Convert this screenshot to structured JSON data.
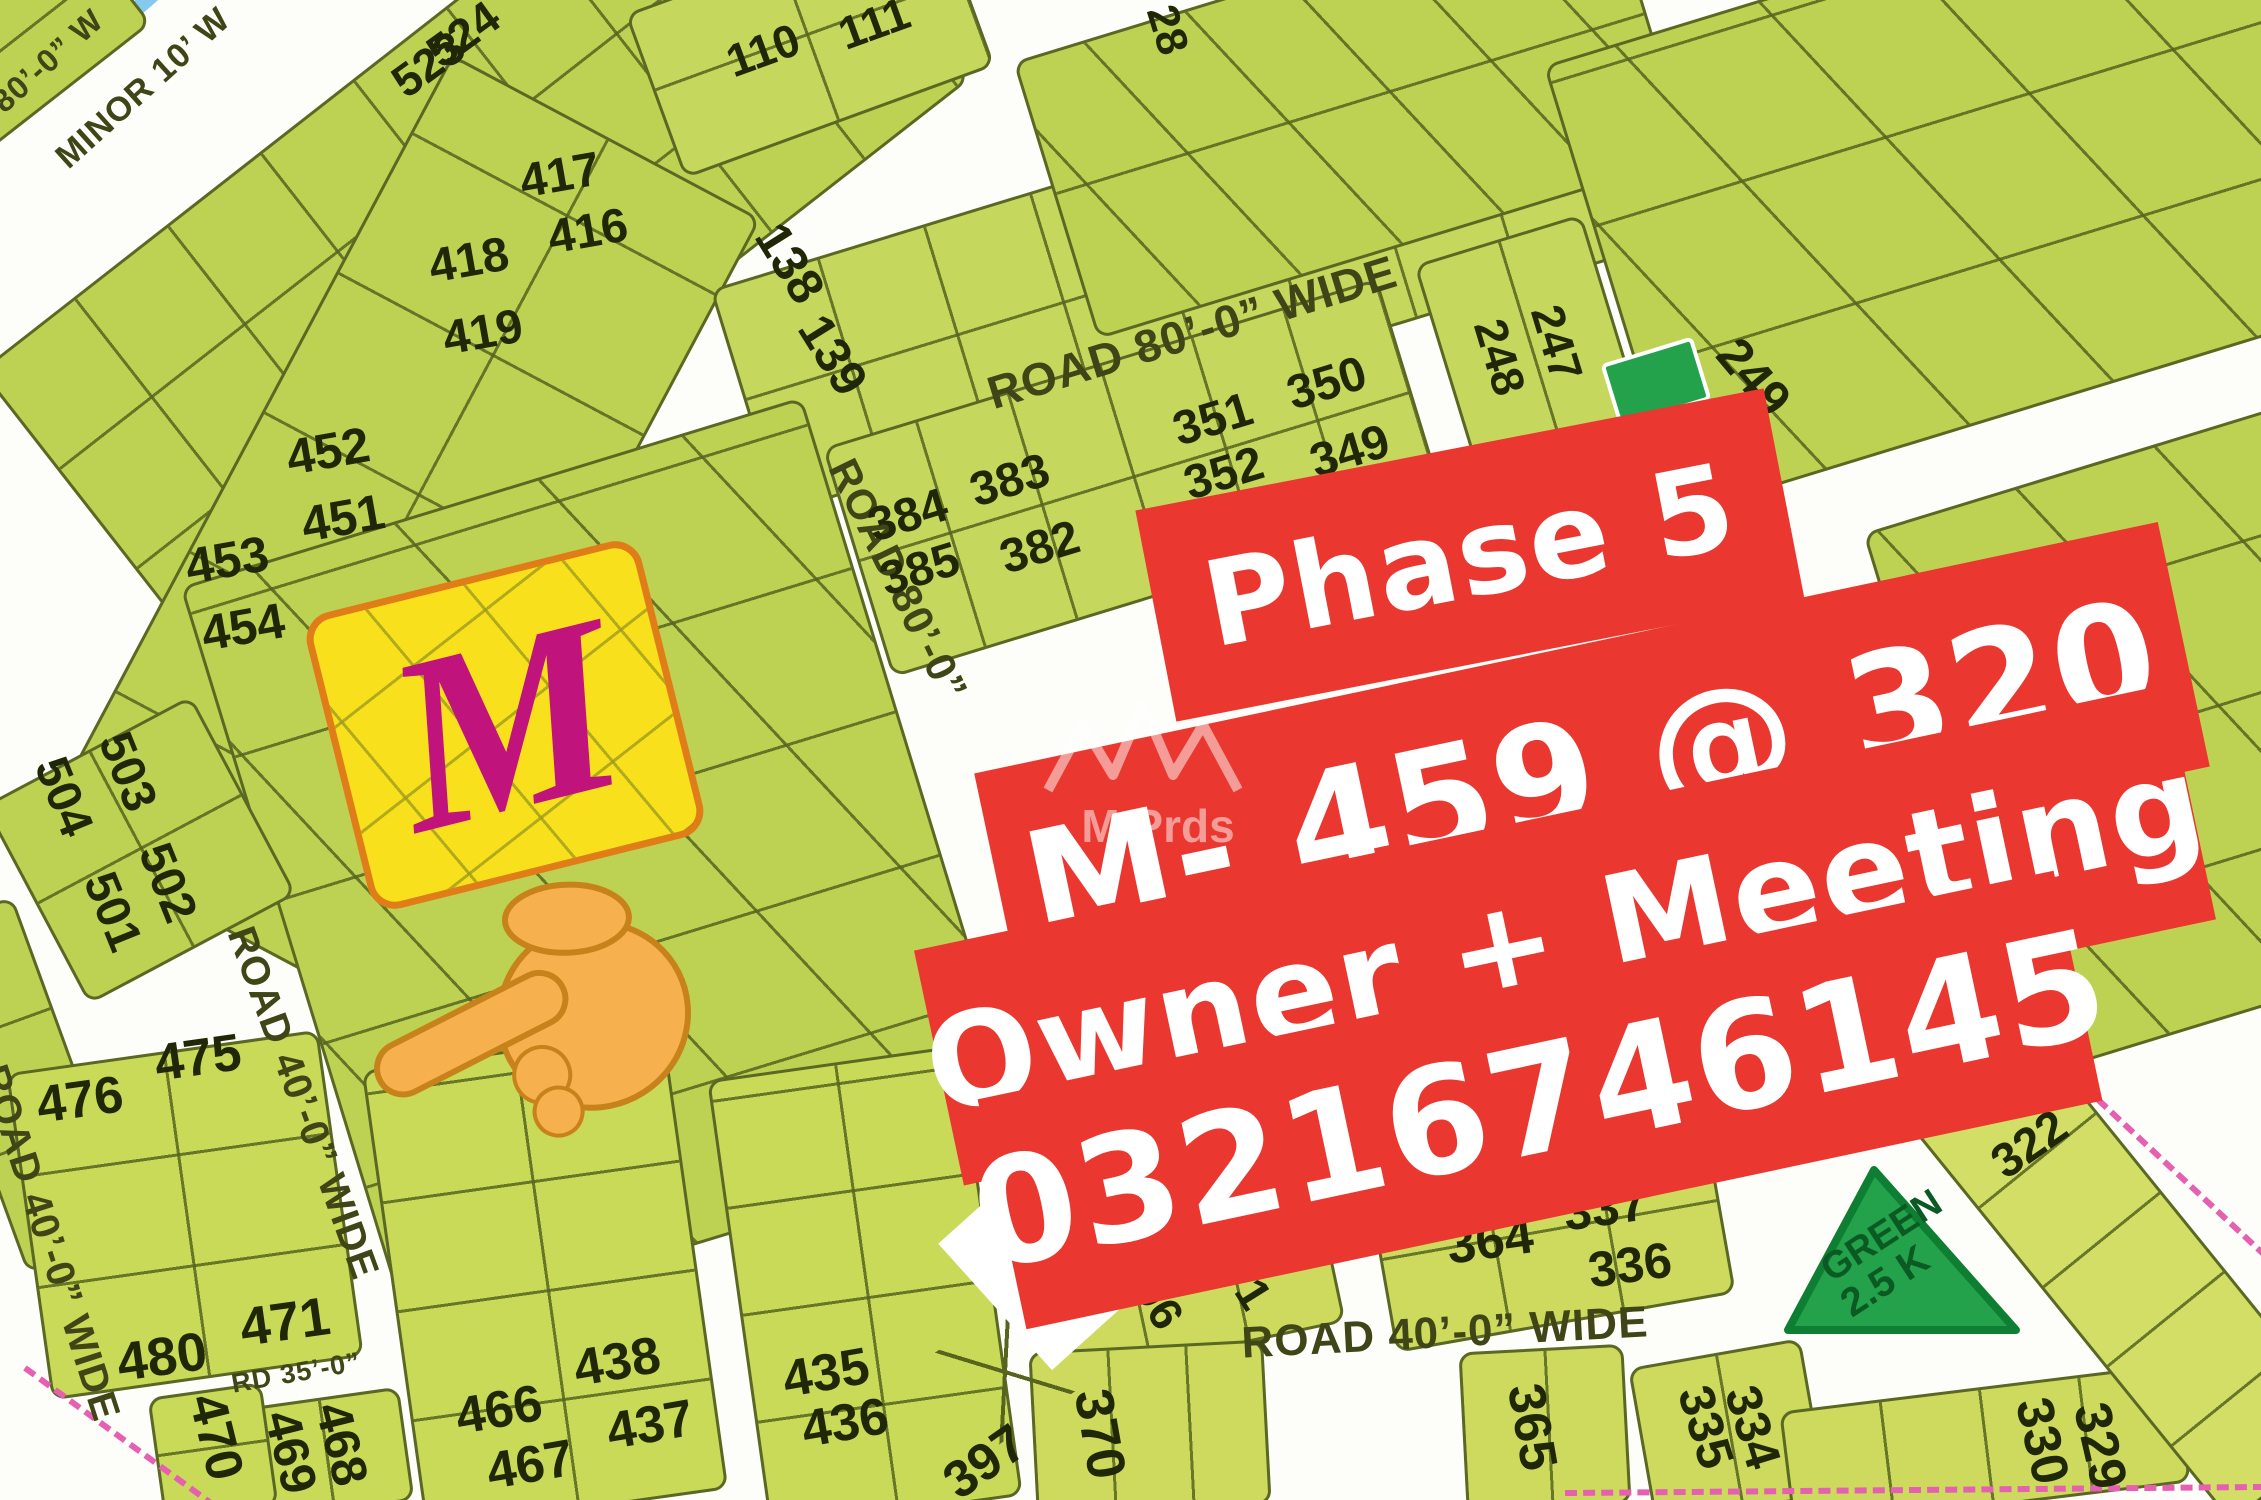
{
  "canvas": {
    "width": 2261,
    "height": 1500,
    "background": "#fdfdfa"
  },
  "colors": {
    "plot_green": "#bdd253",
    "plot_green_light": "#c6d75e",
    "plot_green_warm": "#cdda5e",
    "grid_line": "#56641e",
    "road_white": "#ffffff",
    "sticker_red": "#ea3830",
    "label_dark": "#1f2706",
    "park_green": "#23a14b",
    "canal_blue": "#85c9ec",
    "boundary_pink": "#e560b0",
    "logo_yellow": "#f8e01c",
    "logo_border_orange": "#e07d18",
    "logo_magenta": "#c0137c",
    "hand_skin": "#f6b04e"
  },
  "overlay": {
    "lines": [
      {
        "text": "Phase 5",
        "cx": 1470,
        "cy": 555,
        "w": 640,
        "h": 215,
        "rot": -11,
        "fs": 118
      },
      {
        "text": "M- 459 @ 320",
        "cx": 1592,
        "cy": 770,
        "w": 1210,
        "h": 250,
        "rot": -12,
        "fs": 148
      },
      {
        "text": "Owner + Meeting",
        "cx": 1565,
        "cy": 935,
        "w": 1280,
        "h": 240,
        "rot": -12,
        "fs": 130
      },
      {
        "text": "03216746145",
        "cx": 1540,
        "cy": 1100,
        "w": 1100,
        "h": 235,
        "rot": -12,
        "fs": 148
      }
    ],
    "fold_wedge": {
      "cx": 1075,
      "cy": 1235,
      "w": 215,
      "h": 170,
      "rot": -42
    }
  },
  "logo": {
    "letter": "M",
    "cx": 505,
    "cy": 725,
    "w": 345,
    "h": 305,
    "rot": -14,
    "font_size": 250
  },
  "hand": {
    "icon": "pointing-hand",
    "cx": 540,
    "cy": 1020,
    "w": 350,
    "h": 280,
    "rot": -27
  },
  "watermark": {
    "text": "M Prds",
    "cx": 1158,
    "cy": 775
  },
  "map": {
    "blocks": [
      {
        "id": "A",
        "cx": 475,
        "cy": 225,
        "w": 960,
        "h": 380,
        "rot": -38,
        "col": 118,
        "row": 126,
        "fill": "#bdd253"
      },
      {
        "id": "A2",
        "cx": 15,
        "cy": 35,
        "w": 230,
        "h": 150,
        "rot": -38,
        "col": 0,
        "row": 70,
        "fill": "#bdd253"
      },
      {
        "id": "B",
        "cx": 400,
        "cy": 525,
        "w": 350,
        "h": 880,
        "rot": 28,
        "col": 176,
        "row": 158,
        "fill": "#bdd253"
      },
      {
        "id": "C1",
        "cx": 810,
        "cy": 40,
        "w": 330,
        "h": 175,
        "rot": -20,
        "col": 163,
        "row": 92,
        "fill": "#c6d75e"
      },
      {
        "id": "C2",
        "cx": 1170,
        "cy": 272,
        "w": 890,
        "h": 235,
        "rot": -17,
        "col": 111,
        "row": 118,
        "fill": "#c6d75e"
      },
      {
        "id": "D1",
        "cx": 1135,
        "cy": 478,
        "w": 580,
        "h": 240,
        "rot": -17,
        "col": 96,
        "row": 120,
        "fill": "#c6d75e"
      },
      {
        "id": "D2",
        "cx": 1532,
        "cy": 352,
        "w": 175,
        "h": 235,
        "rot": -17,
        "col": 87,
        "row": 0,
        "fill": "#c6d75e"
      },
      {
        "id": "E1",
        "cx": 1352,
        "cy": 110,
        "w": 620,
        "h": 290,
        "rot": -17,
        "col": 95,
        "row": 150,
        "slant": true,
        "fill": "#bdd253"
      },
      {
        "id": "E2",
        "cx": 1990,
        "cy": 175,
        "w": 790,
        "h": 470,
        "rot": -17,
        "col": 135,
        "row": 150,
        "slant": true,
        "fill": "#bdd253"
      },
      {
        "id": "F",
        "cx": 2195,
        "cy": 730,
        "w": 520,
        "h": 570,
        "rot": -17,
        "col": 130,
        "row": 150,
        "slant": true,
        "fill": "#bdd253"
      },
      {
        "id": "L",
        "cx": 605,
        "cy": 865,
        "w": 650,
        "h": 780,
        "rot": -17,
        "col": 135,
        "row": 150,
        "slant": true,
        "fill": "#bdd253"
      },
      {
        "id": "J2",
        "cx": 140,
        "cy": 850,
        "w": 235,
        "h": 225,
        "rot": -28,
        "col": 118,
        "row": 112,
        "fill": "#bdd253"
      },
      {
        "id": "J1",
        "cx": 20,
        "cy": 1085,
        "w": 115,
        "h": 360,
        "rot": -20,
        "col": 0,
        "row": 120,
        "fill": "#bdd253"
      },
      {
        "id": "K",
        "cx": 185,
        "cy": 1215,
        "w": 315,
        "h": 330,
        "rot": -8,
        "col": 158,
        "row": 112,
        "fill": "#c9d958"
      },
      {
        "id": "K2",
        "cx": 325,
        "cy": 1455,
        "w": 165,
        "h": 115,
        "rot": -8,
        "col": 83,
        "row": 0,
        "fill": "#c9d958"
      },
      {
        "id": "K3",
        "cx": 213,
        "cy": 1452,
        "w": 115,
        "h": 125,
        "rot": -8,
        "col": 0,
        "row": 65,
        "fill": "#c9d958"
      },
      {
        "id": "H1",
        "cx": 545,
        "cy": 1280,
        "w": 305,
        "h": 465,
        "rot": -8,
        "col": 153,
        "row": 110,
        "fill": "#c9d958"
      },
      {
        "id": "H2",
        "cx": 865,
        "cy": 1288,
        "w": 255,
        "h": 455,
        "rot": -8,
        "col": 128,
        "row": 108,
        "fill": "#c9d958"
      },
      {
        "id": "P",
        "cx": 1185,
        "cy": 1287,
        "w": 300,
        "h": 135,
        "rot": -12,
        "col": 100,
        "row": 0,
        "fill": "#cdda5e"
      },
      {
        "id": "I1",
        "cx": 1150,
        "cy": 1428,
        "w": 235,
        "h": 165,
        "rot": -3,
        "col": 78,
        "row": 0,
        "fill": "#cdda5e"
      },
      {
        "id": "I2",
        "cx": 1545,
        "cy": 1428,
        "w": 165,
        "h": 160,
        "rot": -3,
        "col": 85,
        "row": 0,
        "fill": "#cdda5e"
      },
      {
        "id": "I3",
        "cx": 1550,
        "cy": 1232,
        "w": 345,
        "h": 185,
        "rot": -10,
        "col": 115,
        "row": 93,
        "fill": "#cdda5e"
      },
      {
        "id": "I4",
        "cx": 1728,
        "cy": 1432,
        "w": 175,
        "h": 160,
        "rot": -10,
        "col": 88,
        "row": 0,
        "fill": "#cdda5e"
      },
      {
        "id": "I5",
        "cx": 1985,
        "cy": 1447,
        "w": 400,
        "h": 120,
        "rot": -7,
        "col": 100,
        "row": 0,
        "fill": "#cdda5e"
      },
      {
        "id": "G",
        "cx": 2100,
        "cy": 1238,
        "w": 610,
        "h": 155,
        "rot": 51,
        "col": 102,
        "row": 0,
        "fill": "#d2de66"
      }
    ],
    "plot_labels": [
      [
        "524",
        463,
        34,
        -36,
        46
      ],
      [
        "523",
        428,
        64,
        -36,
        46
      ],
      [
        "110",
        763,
        50,
        -20,
        46
      ],
      [
        "111",
        874,
        23,
        -20,
        46
      ],
      [
        "417",
        560,
        176,
        -10,
        48
      ],
      [
        "416",
        588,
        232,
        -10,
        48
      ],
      [
        "418",
        469,
        261,
        -10,
        48
      ],
      [
        "419",
        483,
        333,
        -10,
        48
      ],
      [
        "138",
        790,
        263,
        58,
        50
      ],
      [
        "139",
        833,
        355,
        58,
        50
      ],
      [
        "28",
        1167,
        30,
        73,
        44
      ],
      [
        "452",
        328,
        451,
        -10,
        50
      ],
      [
        "451",
        343,
        518,
        -10,
        50
      ],
      [
        "453",
        227,
        560,
        -10,
        50
      ],
      [
        "454",
        243,
        627,
        -10,
        50
      ],
      [
        "503",
        127,
        772,
        68,
        48
      ],
      [
        "504",
        63,
        797,
        68,
        48
      ],
      [
        "502",
        167,
        883,
        68,
        48
      ],
      [
        "501",
        112,
        912,
        68,
        48
      ],
      [
        "384",
        908,
        516,
        -17,
        48
      ],
      [
        "383",
        1010,
        481,
        -17,
        48
      ],
      [
        "385",
        920,
        570,
        -17,
        48
      ],
      [
        "382",
        1040,
        548,
        -17,
        48
      ],
      [
        "351",
        1213,
        420,
        -17,
        48
      ],
      [
        "350",
        1327,
        384,
        -17,
        48
      ],
      [
        "352",
        1224,
        474,
        -17,
        48
      ],
      [
        "349",
        1350,
        452,
        -17,
        48
      ],
      [
        "247",
        1557,
        343,
        73,
        46
      ],
      [
        "248",
        1500,
        357,
        73,
        46
      ],
      [
        "249",
        1754,
        377,
        50,
        50
      ],
      [
        "476",
        80,
        1100,
        -8,
        52
      ],
      [
        "475",
        198,
        1058,
        -8,
        52
      ],
      [
        "480",
        162,
        1357,
        -8,
        54
      ],
      [
        "471",
        285,
        1322,
        -8,
        54
      ],
      [
        "470",
        216,
        1437,
        76,
        52
      ],
      [
        "469",
        291,
        1452,
        76,
        50
      ],
      [
        "468",
        342,
        1444,
        76,
        50
      ],
      [
        "466",
        499,
        1410,
        -10,
        52
      ],
      [
        "438",
        617,
        1362,
        -10,
        52
      ],
      [
        "467",
        530,
        1465,
        -10,
        52
      ],
      [
        "437",
        650,
        1425,
        -10,
        52
      ],
      [
        "435",
        826,
        1373,
        -10,
        52
      ],
      [
        "436",
        845,
        1423,
        -10,
        52
      ],
      [
        "397",
        985,
        1462,
        -35,
        52
      ],
      [
        "396",
        1152,
        1292,
        58,
        46
      ],
      [
        "371",
        1240,
        1272,
        58,
        46
      ],
      [
        "370",
        1100,
        1434,
        80,
        54
      ],
      [
        "365",
        1532,
        1427,
        80,
        52
      ],
      [
        "364",
        1490,
        1241,
        -8,
        52
      ],
      [
        "337",
        1605,
        1208,
        -8,
        50
      ],
      [
        "336",
        1630,
        1265,
        -8,
        50
      ],
      [
        "335",
        1706,
        1427,
        73,
        50
      ],
      [
        "334",
        1753,
        1427,
        73,
        50
      ],
      [
        "330",
        2042,
        1441,
        77,
        52
      ],
      [
        "329",
        2100,
        1446,
        77,
        52
      ],
      [
        "322",
        2030,
        1145,
        -35,
        48
      ],
      [
        "321",
        1972,
        1062,
        -35,
        48
      ]
    ],
    "road_labels": [
      [
        "MINOR 10’ W",
        143,
        88,
        -42,
        34
      ],
      [
        "AD 80’-0” W",
        26,
        80,
        -42,
        32
      ],
      [
        "ROAD 80’-0” WIDE",
        1192,
        332,
        -17,
        46
      ],
      [
        "ROAD 80’-0”",
        898,
        580,
        64,
        42
      ],
      [
        "ROAD 40’-0” WIDE",
        50,
        1243,
        72,
        40
      ],
      [
        "ROAD 40’-0” WIDE",
        303,
        1103,
        70,
        40
      ],
      [
        "RD 35’-0”",
        296,
        1373,
        -10,
        27
      ],
      [
        "ROAD 40’-0” WIDE",
        1445,
        1333,
        -3,
        44
      ]
    ],
    "green_triangle": {
      "lines": [
        "GREEN",
        "2.5 K"
      ],
      "x": 1770,
      "y": 1150,
      "w": 260,
      "h": 190,
      "pts": "18,180 104,20 246,180",
      "text_rot": -33
    },
    "green_square": {
      "cx": 1656,
      "cy": 382,
      "w": 96,
      "h": 66,
      "rot": -17
    },
    "canal": {
      "cx": 80,
      "cy": 58,
      "len": 270,
      "rot": -41
    },
    "dashed_lines": [
      {
        "cx": 120,
        "cy": 1437,
        "len": 235,
        "rot": 36
      },
      {
        "cx": 1915,
        "cy": 1490,
        "len": 700,
        "rot": -0.5
      },
      {
        "cx": 2182,
        "cy": 1178,
        "len": 230,
        "rot": 43
      }
    ],
    "x_marks": [
      {
        "cx": 1005,
        "cy": 1372,
        "w": 125,
        "h": 112,
        "rot": -35
      }
    ]
  }
}
